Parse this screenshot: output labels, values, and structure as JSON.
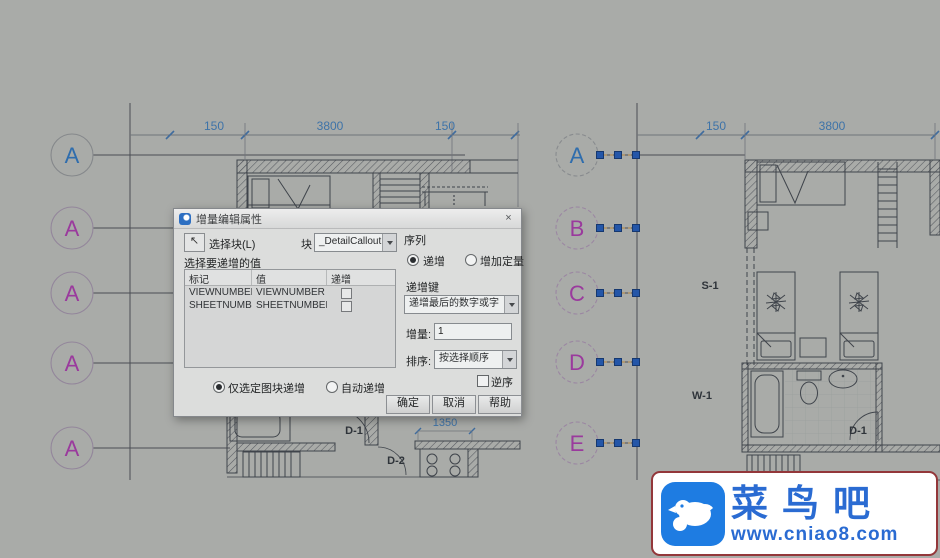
{
  "app": {
    "background": "#a9aba8",
    "dim_color": "#3e73a8",
    "grip_color": "#2456a8"
  },
  "dialog": {
    "title": "增量编辑属性",
    "close_glyph": "×",
    "pick_glyph": "↖",
    "select_block": "选择块(L)",
    "block": "块",
    "block_name": "_DetailCallout",
    "attrs_label": "选择要递增的值",
    "col_tag": "标记",
    "col_value": "值",
    "col_inc": "递增",
    "rows": [
      {
        "tag": "VIEWNUMBER",
        "value": "VIEWNUMBER"
      },
      {
        "tag": "SHEETNUMBER",
        "value": "SHEETNUMBER"
      }
    ],
    "sequence": "序列",
    "opt_increment": "递增",
    "opt_add_fixed": "增加定量",
    "inc_key": "递增键",
    "inc_mode": "递增最后的数字或字",
    "amount": "增量:",
    "amount_value": "1",
    "order": "排序:",
    "order_value": "按选择顺序",
    "reverse": "逆序",
    "opt_selected_only": "仅选定图块递增",
    "opt_auto": "自动递增",
    "ok": "确定",
    "cancel": "取消",
    "help": "帮助"
  },
  "left_plan": {
    "bubbles": [
      "A",
      "A",
      "A",
      "A",
      "A"
    ],
    "dim_150a": "150",
    "dim_3800": "3800",
    "dim_150b": "150",
    "dim_1350": "1350",
    "door_d1": "D-1",
    "door_d2": "D-2"
  },
  "right_plan": {
    "bubbles": [
      "A",
      "B",
      "C",
      "D",
      "E"
    ],
    "dim_150": "150",
    "dim_3800": "3800",
    "label_s1": "S-1",
    "label_w1": "W-1",
    "label_d1": "D-1"
  },
  "watermark": {
    "name": "菜鸟吧",
    "url": "www.cniao8.com"
  }
}
